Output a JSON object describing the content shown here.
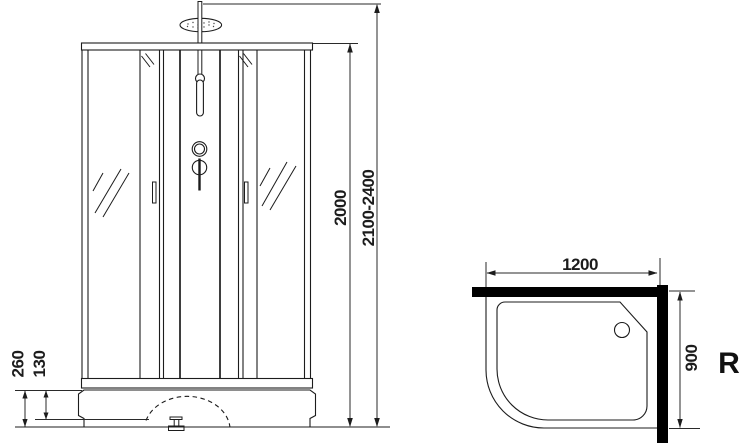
{
  "colors": {
    "background": "#ffffff",
    "line": "#1c1c1c",
    "dimension_line": "#2a2a2a",
    "wall": "#000000"
  },
  "front_view": {
    "label_total_height": "2100-2400",
    "label_cabin_height": "2000",
    "label_tray_height": "260",
    "label_tray_step": "130"
  },
  "top_view": {
    "label_width": "1200",
    "label_depth": "900",
    "label_orientation": "R"
  }
}
